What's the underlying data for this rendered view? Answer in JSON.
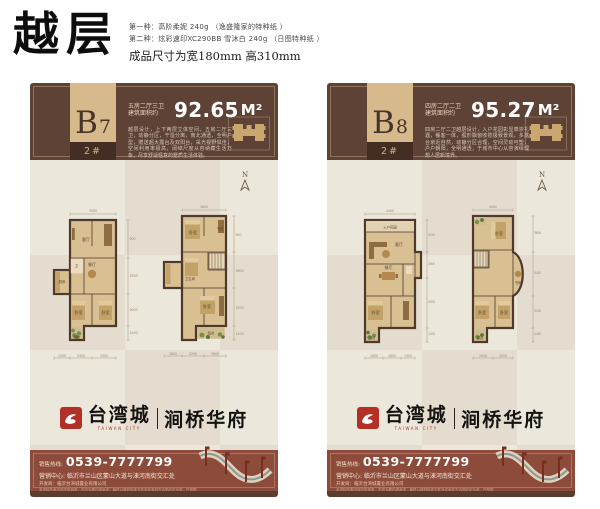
{
  "page": {
    "title": "越层",
    "specs": {
      "line1": "第一种：高阶柔妮 240g （逸盛隆家的特种纸 ）",
      "line2": "第二种：炫彩速印XC290BB 雪沐白 240g （日图特种纸 ）",
      "size_line": "成品尺寸为宽180mm  高310mm"
    }
  },
  "shared": {
    "north_label": "N",
    "logo": {
      "brand": "台湾城",
      "brand_caption": "TAIWAN CITY",
      "sub_brand": "涧桥华府"
    },
    "footer": {
      "hotline_label": "销售热线:",
      "phone": "0539-7777799",
      "address": "营销中心: 临沂市兰山区蒙山大道与涑河南街交汇处",
      "fine_print": "开发商：临沂台湾城置业有限公司",
      "disclaimer": "本资料所有内容仅供参考，不作为要约或承诺，最终以政府批准文件及买卖双方合同约定为准，户型图仅为示意，解释权归开发商所有。"
    },
    "colors": {
      "accent_red": "#b23026",
      "header_brown": "#5e4236",
      "footer_red": "#8d4c3b",
      "tab_tan": "#d6ba8c"
    }
  },
  "panels": [
    {
      "unit_letter": "B",
      "unit_number": "7",
      "block": "2#",
      "rooms": "五房二厅三卫",
      "area_label": "建筑面积约",
      "area_value": "92.65",
      "area_unit": "M²",
      "description": "越层设计，上下两层立体空间，五房二厅三卫，动静分区，干湿分离，南北通透，全明户型，赠送超大露台及双阳台，采光视野俱佳，空间利用率极高，阔绰尺度从容纳藏生活万象，尽享舒适惬意的墅质生活体验。",
      "plans": [
        {
          "labels": [
            "客厅",
            "餐厅",
            "厨房",
            "卫",
            "卧室",
            "卧室",
            "阳台"
          ],
          "dims": {
            "top": "3300",
            "bottom": [
              "1500",
              "2400",
              "3300"
            ],
            "right": [
              "900",
              "3300",
              "3000",
              "1400"
            ]
          }
        },
        {
          "labels": [
            "卧室",
            "书房",
            "卫生间",
            "卧室",
            "阳台"
          ],
          "dims": {
            "top": "3600",
            "bottom": [
              "1800",
              "2200",
              "3600"
            ],
            "right": [
              "900",
              "3600",
              "3200",
              "1400"
            ]
          }
        }
      ]
    },
    {
      "unit_letter": "B",
      "unit_number": "8",
      "block": "2#",
      "rooms": "四房二厅二卫",
      "area_label": "建筑面积约",
      "area_value": "95.27",
      "area_unit": "M²",
      "description": "四房二厅二卫越层设计，入户花园彰显尊崇礼遇，餐客一体，弧形飘窗收揽极致景观，多露台亲近自然，动静分区合理，空间灵动可塑，户户朝阳，全明通透，于城市中心从容演绎理想人居新境界。",
      "plans": [
        {
          "labels": [
            "入户花园",
            "客厅",
            "餐厅",
            "卧室",
            "阳台"
          ],
          "dims": {
            "top": "4400",
            "bottom": [
              "1800",
              "1800",
              "1400"
            ],
            "right": [
              "3200",
              "2600",
              "5000",
              "1400"
            ]
          }
        },
        {
          "labels": [
            "卧室",
            "书房",
            "卧室",
            "卧室",
            "露台"
          ],
          "dims": {
            "top": "4400",
            "bottom": [
              "2000",
              "2000"
            ],
            "right": [
              "3600",
              "4400",
              "3200",
              "1400"
            ]
          }
        }
      ]
    }
  ]
}
